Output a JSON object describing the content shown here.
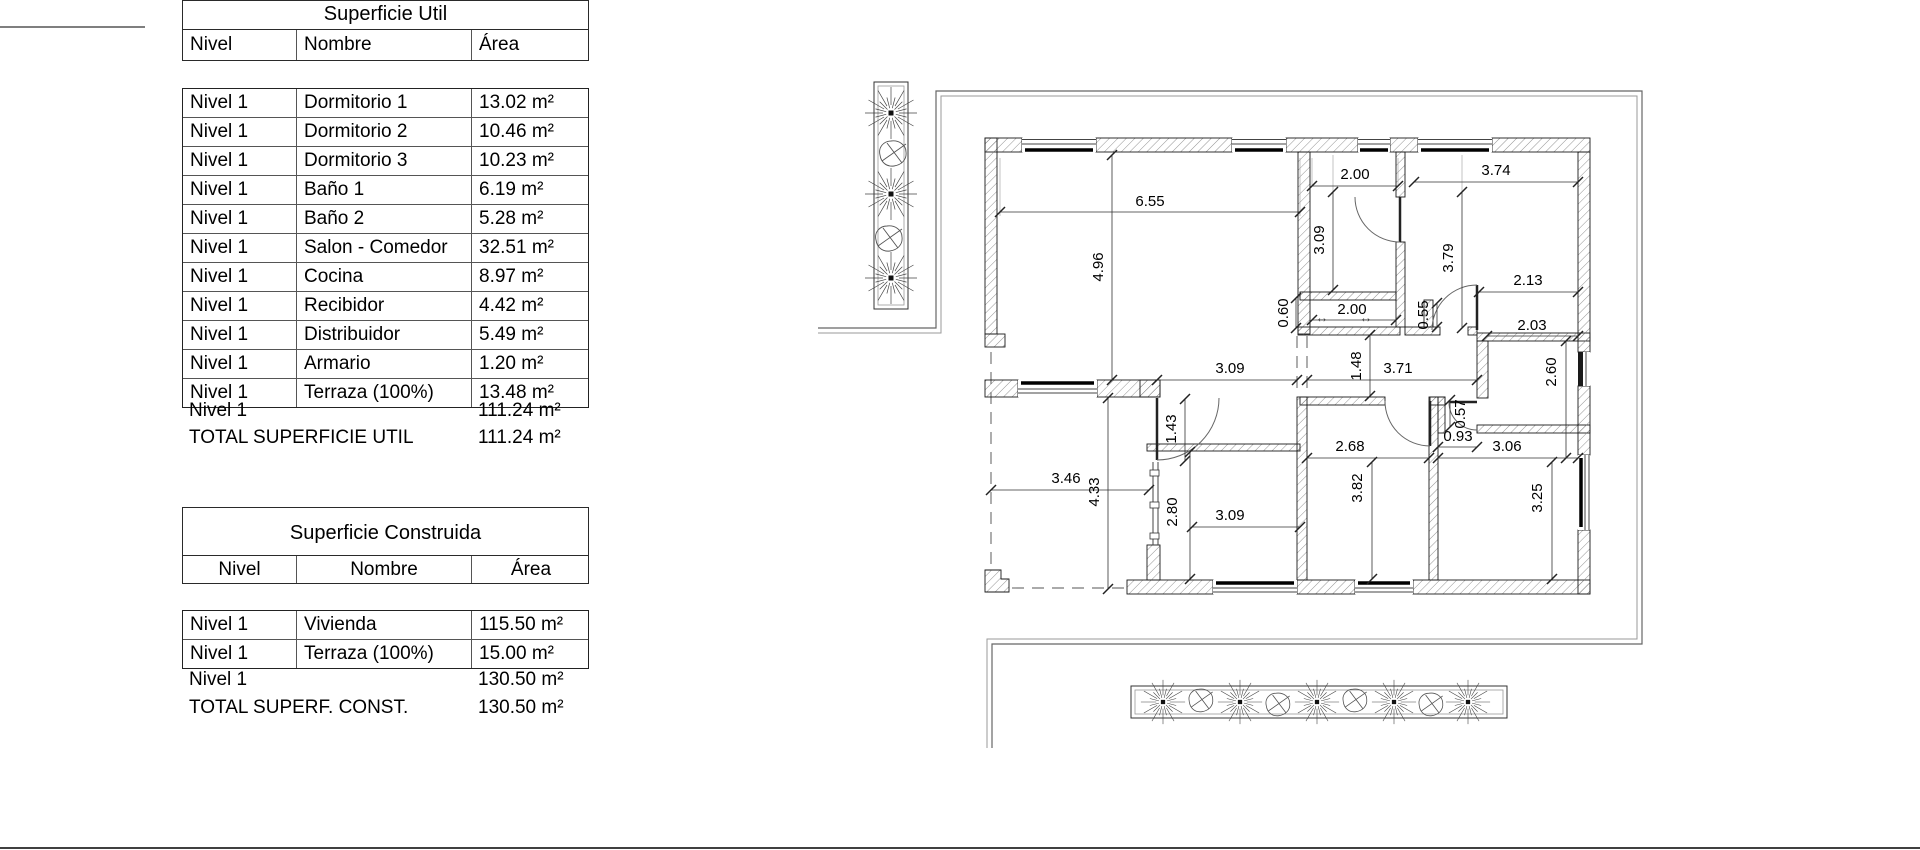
{
  "tables": {
    "util": {
      "title": "Superficie Util",
      "headers": [
        "Nivel",
        "Nombre",
        "Área"
      ],
      "rows": [
        [
          "Nivel 1",
          "Dormitorio 1",
          "13.02 m²"
        ],
        [
          "Nivel 1",
          "Dormitorio 2",
          "10.46 m²"
        ],
        [
          "Nivel 1",
          "Dormitorio 3",
          "10.23 m²"
        ],
        [
          "Nivel 1",
          "Baño 1",
          "6.19 m²"
        ],
        [
          "Nivel 1",
          "Baño 2",
          "5.28 m²"
        ],
        [
          "Nivel 1",
          "Salon - Comedor",
          "32.51 m²"
        ],
        [
          "Nivel 1",
          "Cocina",
          "8.97 m²"
        ],
        [
          "Nivel 1",
          "Recibidor",
          "4.42 m²"
        ],
        [
          "Nivel 1",
          "Distribuidor",
          "5.49 m²"
        ],
        [
          "Nivel 1",
          "Armario",
          "1.20 m²"
        ],
        [
          "Nivel 1",
          "Terraza (100%)",
          "13.48 m²"
        ]
      ],
      "subtotal": {
        "level": "Nivel 1",
        "area": "111.24 m²"
      },
      "total": {
        "label": "TOTAL SUPERFICIE UTIL",
        "area": "111.24 m²"
      }
    },
    "construida": {
      "title": "Superficie Construida",
      "headers": [
        "Nivel",
        "Nombre",
        "Área"
      ],
      "rows": [
        [
          "Nivel 1",
          "Vivienda",
          "115.50 m²"
        ],
        [
          "Nivel 1",
          "Terraza (100%)",
          "15.00 m²"
        ]
      ],
      "subtotal": {
        "level": "Nivel 1",
        "area": "130.50 m²"
      },
      "total": {
        "label": "TOTAL SUPERF. CONST.",
        "area": "130.50 m²"
      }
    }
  },
  "plan": {
    "dims": {
      "salon_w": "6.55",
      "salon_h": "4.96",
      "bano1_w": "2.00",
      "bano1_h": "3.09",
      "dorm1_w": "3.74",
      "dorm1_h": "3.79",
      "wardrobe_w": "2.13",
      "armario_h": "0.60",
      "armario_w": "2.00",
      "stub_h": "0.55",
      "bano2_w": "2.03",
      "bano2_h": "2.60",
      "recibidor_w": "3.09",
      "pasillo_h": "1.48",
      "distribuidor_w": "3.71",
      "entrada_h": "1.43",
      "terraza_w": "3.46",
      "terraza_h": "4.33",
      "cocina_h": "2.80",
      "cocina_w": "3.09",
      "dorm2_w": "2.68",
      "dorm2_h": "3.82",
      "dorm3_w": "3.06",
      "dorm3_h": "3.25",
      "paso_w": "0.93",
      "paso_h": "0.57"
    },
    "arrow_glyph": "↔"
  }
}
